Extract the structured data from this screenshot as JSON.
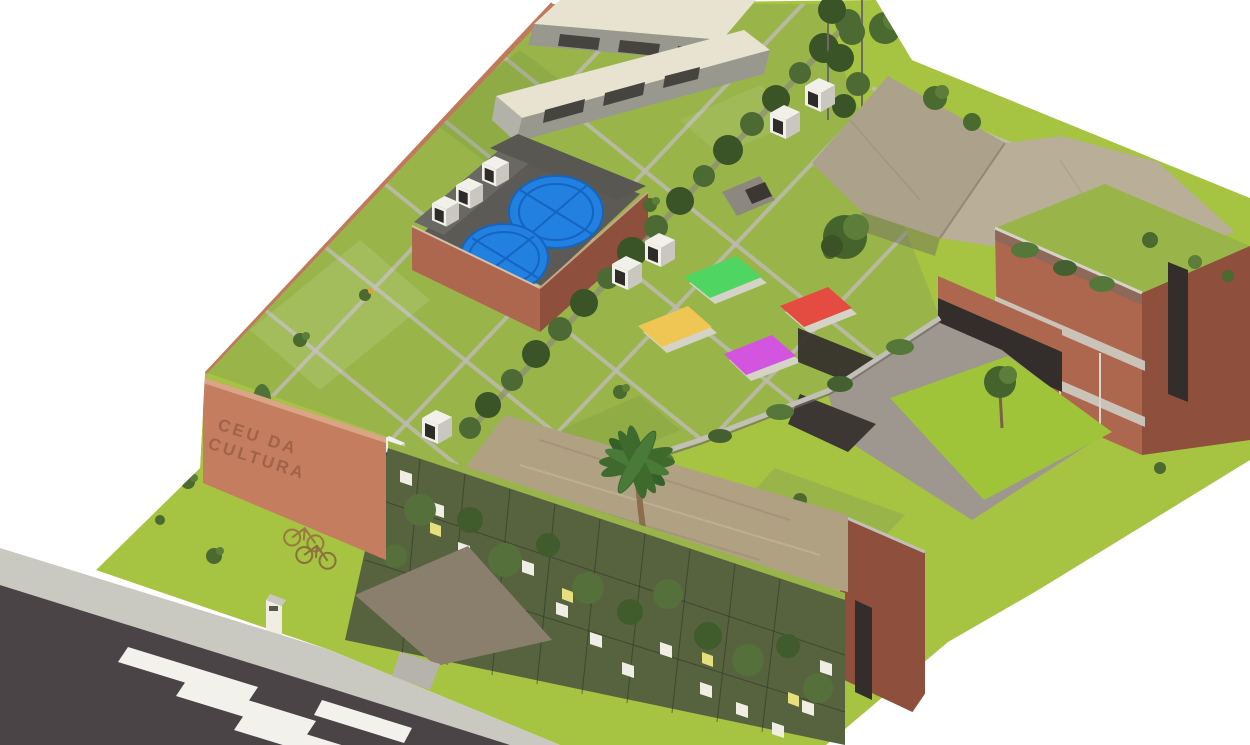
{
  "scene": {
    "sign": {
      "line1": "CEU DA",
      "line2": "CULTURA"
    }
  },
  "colors": {
    "background": "#ffffff",
    "lawn": "#a6c341",
    "lawn_bright": "#9fc43a",
    "roof_grass": "#99b54a",
    "brick_light": "#c47d5e",
    "brick_mid": "#ad674e",
    "brick_dark": "#8e4f3c",
    "concrete_light": "#c9c8c1",
    "concrete_walk": "#bdbbb0",
    "patio_gray": "#9d978f",
    "road_asphalt": "#4a4446",
    "crosswalk_white": "#f2f1ec",
    "shed_roof": "#e8e2d1",
    "shed_side": "#99988e",
    "tan_roof_left": "#aca18a",
    "tan_roof_right": "#b9ae97",
    "thatch_roof": "#b1a183",
    "vine_green": "#4d6a34",
    "vine_dark": "#3a5427",
    "trellis_base": "#57633f",
    "tank_blue": "#2180e0",
    "enclosure_floor": "#5c5a57",
    "skylight_green": "#4fd561",
    "skylight_red": "#e54c41",
    "skylight_yellow": "#efc654",
    "skylight_magenta": "#d354de",
    "dirt_path": "#8a7e6d",
    "panel_white": "#efede4",
    "window_dark": "#332e2b",
    "sign_text": "#9c5f45",
    "unit_white": "#f2f0ea"
  }
}
